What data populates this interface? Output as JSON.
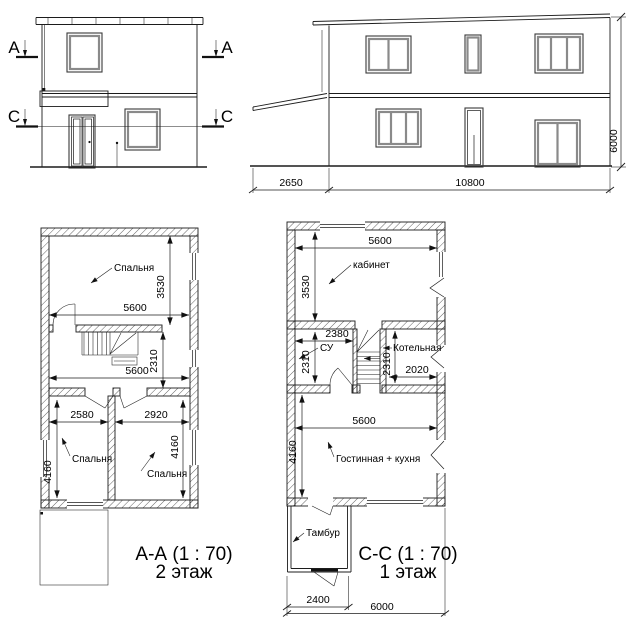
{
  "front_elevation": {
    "section_a": "A",
    "section_c": "C"
  },
  "side_elevation": {
    "dims": {
      "porch_width": "2650",
      "house_width": "10800",
      "height": "6000"
    }
  },
  "floor2_plan": {
    "title": "А-А (1 : 70)",
    "subtitle": "2 этаж",
    "rooms": {
      "bedroom_top": "Спальня",
      "bedroom_left": "Спальня",
      "bedroom_right": "Спальня"
    },
    "dims": {
      "bedroom_top_width": "5600",
      "bedroom_top_depth": "3530",
      "hall_width": "5600",
      "hall_depth": "2310",
      "bedroom_left_width": "2580",
      "bedroom_right_width": "2920",
      "bedroom_left_depth": "4160",
      "bedroom_right_depth": "4160"
    }
  },
  "floor1_plan": {
    "title": "С-С (1 : 70)",
    "subtitle": "1 этаж",
    "rooms": {
      "office": "кабинет",
      "wc": "СУ",
      "boiler": "Котельная",
      "living": "Гостинная + кухня",
      "vestibule": "Тамбур"
    },
    "dims": {
      "office_width": "5600",
      "office_depth": "3530",
      "wc_width": "2380",
      "wc_depth": "2310",
      "boiler_width": "2020",
      "boiler_depth": "2310",
      "living_width": "5600",
      "living_depth": "4160",
      "vestibule_width": "2400",
      "total_width": "6000"
    }
  }
}
